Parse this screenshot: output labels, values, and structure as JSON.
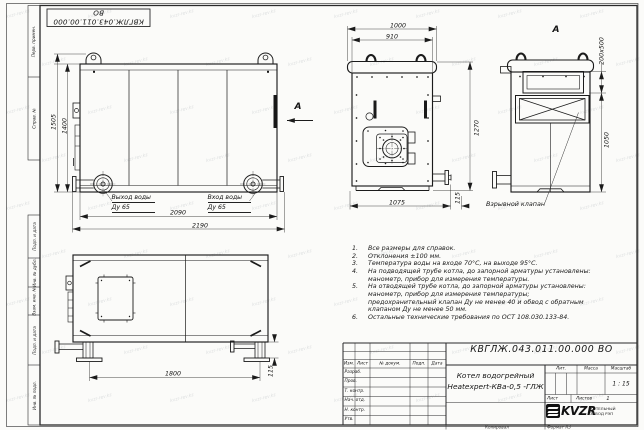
{
  "sheet": {
    "designation_stamp": "КВГЛЖ.043.011.00.000 ВО",
    "watermark": "kvzr-rev.kz",
    "copied_label": "Копировал",
    "format_label": "Формат А3"
  },
  "frame": {
    "labels": [
      "Перв. примен.",
      "Справ. №",
      "Подп. и дата",
      "Инв. № дубл.",
      "Взам. инв. №",
      "Подп. и дата",
      "Инв. № подл."
    ]
  },
  "views": {
    "side": {
      "dim_height_total": "1505",
      "dim_height_body": "1400",
      "dim_width_body": "2090",
      "dim_width_total": "2190",
      "outlet_label": "Выход воды",
      "outlet_dn": "Ду 65",
      "inlet_label": "Вход воды",
      "inlet_dn": "Ду 65",
      "view_arrow_label": "А"
    },
    "front": {
      "dim_width_total": "1000",
      "dim_width_body": "910",
      "dim_height": "1270",
      "dim_bottom": "1075",
      "dim_flange": "115"
    },
    "rear": {
      "view_label": "А",
      "dim_valve": "200х500",
      "dim_height": "1050",
      "valve_label": "Взрывной клапан"
    },
    "side2": {
      "dim_feet": "1800",
      "dim_foot_height": "115"
    }
  },
  "notes": {
    "items": [
      {
        "num": "1.",
        "text": "Все размеры для справок."
      },
      {
        "num": "2.",
        "text": "Отклонения ±100 мм."
      },
      {
        "num": "3.",
        "text": "Температура воды на входе 70°С, на выходе 95°С."
      },
      {
        "num": "4.",
        "text": "На подводящей трубе котла, до запорной арматуры установлены: манометр, прибор для измерения температуры."
      },
      {
        "num": "5.",
        "text": "На отводящей трубе котла, до запорной арматуры установлены: манометр, прибор для измерения температуры; предохранительный клапан Ду не менее 40 и обвод с обратным клапаном Ду не менее 50 мм."
      },
      {
        "num": "6.",
        "text": "Остальные технические требования по ОСТ 108.030.133-84."
      }
    ]
  },
  "title_block": {
    "designation": "КВГЛЖ.043.011.00.000 ВО",
    "product_name_line1": "Котел водогрейный",
    "product_name_line2": "Heatexpert-КВа-0,5 -ГЛЖ",
    "header_cols": [
      "Изм.",
      "Лист",
      "№ докум.",
      "Подп.",
      "Дата"
    ],
    "sig_rows": [
      "Разраб.",
      "Пров.",
      "Т. контр.",
      "Нач. отд.",
      "Н. контр.",
      "Утв."
    ],
    "lit_label": "Лит.",
    "mass_label": "Масса",
    "scale_label": "Масштаб",
    "scale_value": "1 : 15",
    "sheet_label": "Лист",
    "sheets_label": "Листов",
    "sheets_value": "1",
    "logo_text": "KVZR",
    "company_line1": "КОТЕЛЬНЫЙ",
    "company_line2": "ЗАВОД РЭП"
  }
}
